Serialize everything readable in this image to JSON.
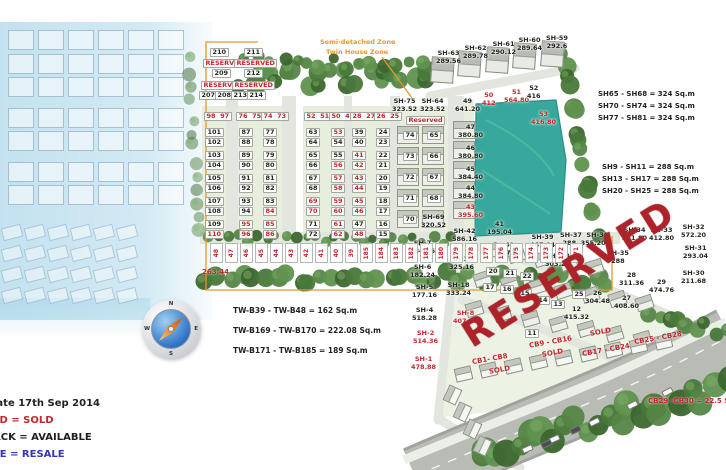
{
  "colors": {
    "sold": "#c3262c",
    "available": "#222222",
    "resale": "#3237b8",
    "zone_line": "#e8962e",
    "pond": "#38a89d",
    "reserved_text": "#b5242b"
  },
  "legend": {
    "update_line": "Update 17th Sep  2014",
    "items": [
      {
        "text": "RED = SOLD",
        "color_class": "red"
      },
      {
        "text": "BLACK = AVAILABLE",
        "color_class": "blk"
      },
      {
        "text": "BLUE = RESALE",
        "color_class": "blu"
      }
    ]
  },
  "zone_labels": {
    "line1": "Semi-detached Zone",
    "line2": "Twin House Zone"
  },
  "compass": {
    "n": "N",
    "e": "E",
    "s": "S",
    "w": "W"
  },
  "reserved_overlay": "RESERVED",
  "boundary_value": "263.44",
  "note_cb": "CB29 -CB30 = 22.5 Sq.m",
  "notes_tw": [
    "TW-B39 - TW-B48 = 162 Sq.m",
    "TW-B169 - TW-B170 = 222.08 Sq.m",
    "TW-B171 - TW-B185 = 189 Sq.m"
  ],
  "notes_sh_large": [
    "SH65 - SH68 = 324 Sq.m",
    "SH70 - SH74 = 324 Sq.m",
    "SH77 - SH81 = 324 Sq.m"
  ],
  "notes_sh_small": [
    "SH9 - SH11 = 288 Sq.m",
    "SH13 - SH17 = 288 Sq.m",
    "SH20 - SH25 = 288 Sq.m"
  ],
  "reserved_block": [
    {
      "t": "210",
      "x": 210,
      "y": 48
    },
    {
      "t": "211",
      "x": 244,
      "y": 48
    },
    {
      "t": "RESERVED",
      "x": 203,
      "y": 59,
      "s": "s"
    },
    {
      "t": "RESERVED",
      "x": 234,
      "y": 59,
      "s": "s"
    },
    {
      "t": "209",
      "x": 212,
      "y": 69
    },
    {
      "t": "212",
      "x": 244,
      "y": 69
    },
    {
      "t": "RESERVED",
      "x": 201,
      "y": 81,
      "s": "s"
    },
    {
      "t": "RESERVED",
      "x": 232,
      "y": 81,
      "s": "s"
    },
    {
      "t": "207",
      "x": 199,
      "y": 91
    },
    {
      "t": "208",
      "x": 215,
      "y": 91
    },
    {
      "t": "213",
      "x": 231,
      "y": 91
    },
    {
      "t": "214",
      "x": 247,
      "y": 91
    }
  ],
  "lot_headers": [
    {
      "t": "98  97",
      "x": 204,
      "y": 112
    },
    {
      "t": "76  75",
      "x": 236,
      "y": 112
    },
    {
      "t": "74  73",
      "x": 261,
      "y": 112
    },
    {
      "t": "52  51",
      "x": 304,
      "y": 112
    },
    {
      "t": "50  49",
      "x": 329,
      "y": 112
    },
    {
      "t": "28  27",
      "x": 350,
      "y": 112
    },
    {
      "t": "26  25",
      "x": 374,
      "y": 112
    }
  ],
  "columns_y": 128,
  "twin_columns": [
    {
      "x": 205,
      "cells": [
        {
          "t": "101"
        },
        {
          "t": "102"
        },
        {
          "t": "103"
        },
        {
          "t": "104"
        },
        {
          "t": "105"
        },
        {
          "t": "106"
        },
        {
          "t": "107"
        },
        {
          "t": "108"
        },
        {
          "t": "109"
        },
        {
          "t": "110",
          "s": "s"
        }
      ]
    },
    {
      "x": 239,
      "cells": [
        {
          "t": "87"
        },
        {
          "t": "88"
        },
        {
          "t": "89"
        },
        {
          "t": "90"
        },
        {
          "t": "91"
        },
        {
          "t": "92"
        },
        {
          "t": "93"
        },
        {
          "t": "94"
        },
        {
          "t": "95",
          "s": "s"
        },
        {
          "t": "96",
          "s": "s"
        }
      ]
    },
    {
      "x": 263,
      "cells": [
        {
          "t": "77"
        },
        {
          "t": "78"
        },
        {
          "t": "79"
        },
        {
          "t": "80"
        },
        {
          "t": "81"
        },
        {
          "t": "82"
        },
        {
          "t": "83"
        },
        {
          "t": "84",
          "s": "s"
        },
        {
          "t": "85",
          "s": "s"
        },
        {
          "t": "86",
          "s": "s"
        }
      ]
    },
    {
      "x": 306,
      "cells": [
        {
          "t": "63"
        },
        {
          "t": "64"
        },
        {
          "t": "65"
        },
        {
          "t": "66"
        },
        {
          "t": "67"
        },
        {
          "t": "68"
        },
        {
          "t": "69",
          "s": "s"
        },
        {
          "t": "70",
          "s": "s"
        },
        {
          "t": "71"
        },
        {
          "t": "72"
        }
      ]
    },
    {
      "x": 331,
      "cells": [
        {
          "t": "53",
          "s": "s"
        },
        {
          "t": "54"
        },
        {
          "t": "55"
        },
        {
          "t": "56",
          "s": "s"
        },
        {
          "t": "57",
          "s": "s"
        },
        {
          "t": "58",
          "s": "s"
        },
        {
          "t": "59",
          "s": "s"
        },
        {
          "t": "60",
          "s": "s"
        },
        {
          "t": "61",
          "s": "s"
        },
        {
          "t": "62",
          "s": "s"
        }
      ]
    },
    {
      "x": 352,
      "cells": [
        {
          "t": "39"
        },
        {
          "t": "40"
        },
        {
          "t": "41",
          "s": "s"
        },
        {
          "t": "42",
          "s": "s"
        },
        {
          "t": "43",
          "s": "s"
        },
        {
          "t": "44",
          "s": "s"
        },
        {
          "t": "45",
          "s": "s"
        },
        {
          "t": "46",
          "s": "s"
        },
        {
          "t": "47"
        },
        {
          "t": "48",
          "s": "s"
        }
      ]
    },
    {
      "x": 376,
      "cells": [
        {
          "t": "24"
        },
        {
          "t": "23"
        },
        {
          "t": "22"
        },
        {
          "t": "21"
        },
        {
          "t": "20"
        },
        {
          "t": "19"
        },
        {
          "t": "18"
        },
        {
          "t": "17"
        },
        {
          "t": "16"
        },
        {
          "t": "15"
        }
      ]
    }
  ],
  "sh_twin": {
    "headers": [
      {
        "n": "SH-75",
        "a": "323.52",
        "x": 392,
        "y": 98
      },
      {
        "n": "SH-64",
        "a": "323.52",
        "x": 420,
        "y": 98
      }
    ],
    "reserved": {
      "t": "Reserved",
      "x": 406,
      "y": 116
    },
    "left_x": 403,
    "right_x": 427,
    "left": [
      "74",
      "73",
      "72",
      "71",
      "70"
    ],
    "right": [
      "65",
      "66",
      "67",
      "68"
    ],
    "bottom": {
      "n": "SH-69",
      "a": "320.52",
      "x": 421,
      "y": 214
    }
  },
  "area_chips": [
    {
      "n": "49",
      "a": "641.20",
      "x": 455,
      "y": 98
    },
    {
      "n": "50",
      "a": "412",
      "x": 482,
      "y": 92,
      "s": "s"
    },
    {
      "n": "51",
      "a": "564.80",
      "x": 504,
      "y": 89,
      "s": "s"
    },
    {
      "n": "52",
      "a": "416",
      "x": 527,
      "y": 85
    },
    {
      "n": "53",
      "a": "416.80",
      "x": 531,
      "y": 111,
      "s": "s"
    },
    {
      "n": "47",
      "a": "380.80",
      "x": 458,
      "y": 124
    },
    {
      "n": "46",
      "a": "380.80",
      "x": 458,
      "y": 145
    },
    {
      "n": "45",
      "a": "384.40",
      "x": 458,
      "y": 166
    },
    {
      "n": "44",
      "a": "384.80",
      "x": 458,
      "y": 185
    },
    {
      "n": "43",
      "a": "395.60",
      "x": 458,
      "y": 204,
      "s": "s"
    }
  ],
  "value_labels": [
    {
      "n": "SH-63",
      "a": "289.56",
      "x": 436,
      "y": 50
    },
    {
      "n": "SH-62",
      "a": "289.78",
      "x": 463,
      "y": 45
    },
    {
      "n": "SH-61",
      "a": "290.12",
      "x": 491,
      "y": 41
    },
    {
      "n": "SH-60",
      "a": "289.64",
      "x": 517,
      "y": 37
    },
    {
      "n": "SH-59",
      "a": "292.6",
      "x": 546,
      "y": 35
    },
    {
      "n": "SH-42",
      "a": "586.16",
      "x": 452,
      "y": 228
    },
    {
      "n": "41",
      "a": "195.04",
      "x": 487,
      "y": 221
    },
    {
      "n": "40",
      "a": "417.32",
      "x": 497,
      "y": 242
    },
    {
      "n": "SH-39",
      "a": "467.04",
      "x": 530,
      "y": 234
    },
    {
      "n": "SH- 38",
      "a": "303.24",
      "x": 545,
      "y": 253
    },
    {
      "n": "SH-19",
      "a": "325.16",
      "x": 449,
      "y": 256
    },
    {
      "n": "SH-18",
      "a": "333.24",
      "x": 446,
      "y": 282
    },
    {
      "n": "SH-7",
      "a": "184.56",
      "x": 410,
      "y": 240
    },
    {
      "n": "SH-6",
      "a": "182.24",
      "x": 410,
      "y": 264
    },
    {
      "n": "SH-5",
      "a": "177.16",
      "x": 412,
      "y": 284
    },
    {
      "n": "SH-4",
      "a": "518.28",
      "x": 412,
      "y": 307
    },
    {
      "n": "SH-8",
      "a": "407.08",
      "x": 453,
      "y": 310,
      "s": "s"
    },
    {
      "n": "SH-2",
      "a": "514.36",
      "x": 413,
      "y": 330,
      "s": "s"
    },
    {
      "n": "SH-1",
      "a": "478.88",
      "x": 411,
      "y": 356,
      "s": "s"
    },
    {
      "n": "SH-37  SH-36",
      "a": "288  355.20",
      "x": 560,
      "y": 232
    },
    {
      "n": "SH-35",
      "a": "288",
      "x": 607,
      "y": 250
    },
    {
      "n": "SH-34",
      "a": "331.80",
      "x": 622,
      "y": 227
    },
    {
      "n": "SH-33",
      "a": "412.80",
      "x": 649,
      "y": 227
    },
    {
      "n": "SH-32",
      "a": "572.20",
      "x": 681,
      "y": 224
    },
    {
      "n": "SH-31",
      "a": "293.04",
      "x": 683,
      "y": 245
    },
    {
      "n": "SH-30",
      "a": "211.68",
      "x": 681,
      "y": 270
    },
    {
      "n": "28",
      "a": "311.36",
      "x": 619,
      "y": 272
    },
    {
      "n": "29",
      "a": "474.76",
      "x": 649,
      "y": 279
    },
    {
      "n": "27",
      "a": "408.60",
      "x": 614,
      "y": 295
    },
    {
      "n": "26",
      "a": "304.48",
      "x": 585,
      "y": 290
    },
    {
      "n": "12",
      "a": "415.32",
      "x": 564,
      "y": 306
    }
  ],
  "lot_chips": [
    {
      "t": "20",
      "x": 486,
      "y": 267
    },
    {
      "t": "21",
      "x": 503,
      "y": 269
    },
    {
      "t": "22",
      "x": 520,
      "y": 272
    },
    {
      "t": "17",
      "x": 483,
      "y": 283
    },
    {
      "t": "16",
      "x": 500,
      "y": 285
    },
    {
      "t": "15",
      "x": 518,
      "y": 289
    },
    {
      "t": "14",
      "x": 536,
      "y": 296
    },
    {
      "t": "13",
      "x": 551,
      "y": 300
    },
    {
      "t": "11",
      "x": 525,
      "y": 329
    },
    {
      "t": "25",
      "x": 572,
      "y": 290
    }
  ],
  "cb_labels": [
    {
      "t": "CB1- CB8",
      "x": 472,
      "y": 356,
      "rot": -10
    },
    {
      "t": "SOLD",
      "x": 489,
      "y": 367,
      "rot": -10
    },
    {
      "t": "CB9 - CB16",
      "x": 529,
      "y": 339,
      "rot": -10
    },
    {
      "t": "SOLD",
      "x": 542,
      "y": 350,
      "rot": -10
    },
    {
      "t": "SOLD",
      "x": 590,
      "y": 329,
      "rot": -10
    },
    {
      "t": "CB17 - CB24",
      "x": 582,
      "y": 347,
      "rot": -10
    },
    {
      "t": "CB25 - CB28",
      "x": 634,
      "y": 335,
      "rot": -10
    }
  ],
  "bottom_strip": {
    "x": 210,
    "y": 243,
    "numbers": [
      "48",
      "47",
      "46",
      "45",
      "44",
      "43",
      "42",
      "41",
      "40",
      "39",
      "185",
      "184",
      "183",
      "182",
      "181",
      "180",
      "179",
      "178",
      "177",
      "176",
      "175",
      "174",
      "173",
      "172",
      "171"
    ]
  }
}
